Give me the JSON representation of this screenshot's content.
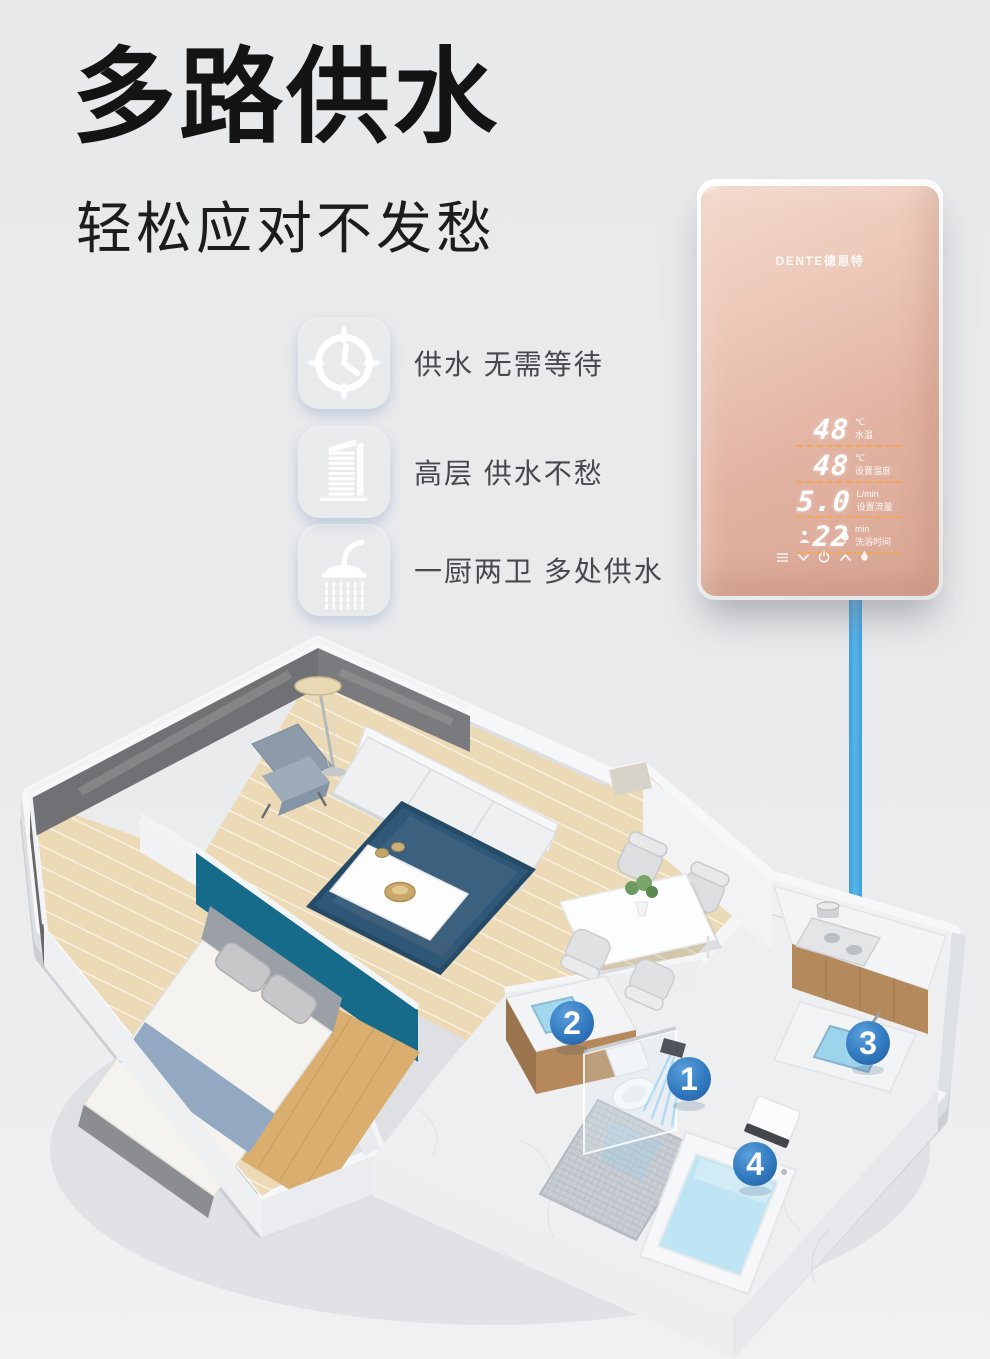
{
  "header": {
    "title": "多路供水",
    "subtitle": "轻松应对不发愁"
  },
  "features": [
    {
      "icon": "clock-icon",
      "label": "供水 无需等待"
    },
    {
      "icon": "building-icon",
      "label": "高层 供水不愁"
    },
    {
      "icon": "shower-icon",
      "label": "一厨两卫 多处供水"
    }
  ],
  "heater": {
    "brand": "DENTE德恩特",
    "display_rows": [
      {
        "value": "48",
        "unit": "℃",
        "label": "水温"
      },
      {
        "value": "48",
        "unit": "℃",
        "label": "设置温度"
      },
      {
        "value": "5.0",
        "unit": "L/min",
        "label": "设置流量"
      },
      {
        "value": "22",
        "unit": "min",
        "label": "洗浴时间"
      }
    ],
    "mode_icons": [
      "person-icon",
      "drop-icon"
    ],
    "control_icons": [
      "menu-icon",
      "chevron-down-icon",
      "power-icon",
      "chevron-up-icon",
      "drop-icon"
    ]
  },
  "floorplan": {
    "markers": [
      {
        "number": "1",
        "point": "shower"
      },
      {
        "number": "2",
        "point": "basin"
      },
      {
        "number": "3",
        "point": "kitchen-sink"
      },
      {
        "number": "4",
        "point": "bathtub"
      }
    ]
  },
  "colors": {
    "accent_blue": "#4a82d4",
    "marker_blue": "#2f7dc2",
    "pipe_blue": "#3fa3e2",
    "panel_rose": "#e2b3a3",
    "teal_wall": "#176b8a",
    "dash_orange": "#f2a64e"
  }
}
